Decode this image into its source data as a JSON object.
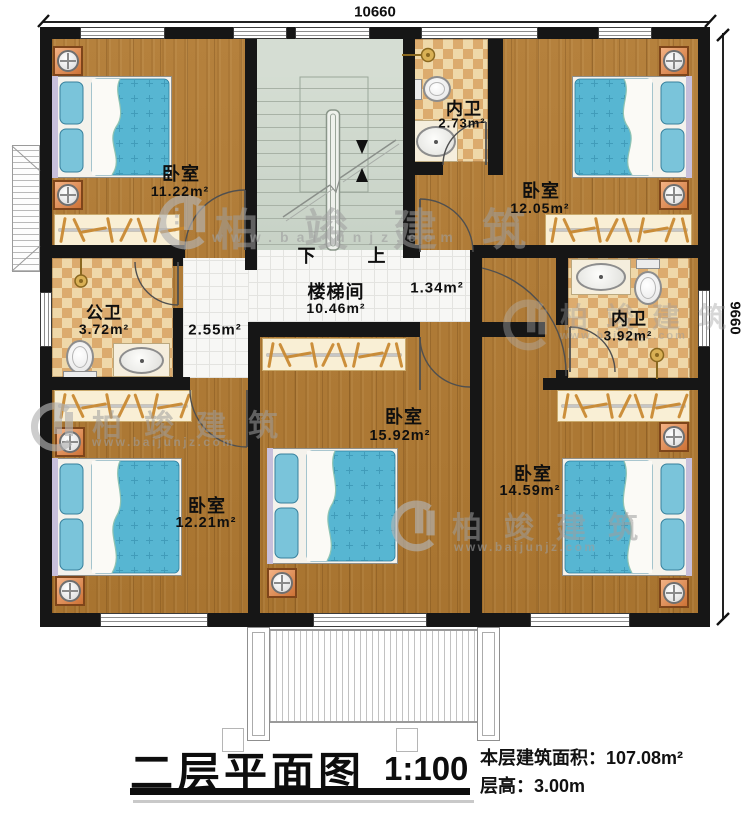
{
  "title_block": {
    "title": "二层平面图",
    "scale": "1:100",
    "area_label": "本层建筑面积：107.08m²",
    "floor_height_label": "层高：3.00m"
  },
  "dimensions": {
    "top": "10660",
    "right": "9660"
  },
  "stair": {
    "down_label": "下",
    "up_label": "上"
  },
  "rooms": [
    {
      "id": "bedroom-top-left",
      "name": "卧室",
      "area": "11.22m²"
    },
    {
      "id": "bath-inner-top",
      "name": "内卫",
      "area": "2.73m²"
    },
    {
      "id": "bedroom-top-right",
      "name": "卧室",
      "area": "12.05m²"
    },
    {
      "id": "bath-public",
      "name": "公卫",
      "area": "3.72m²"
    },
    {
      "id": "stairwell",
      "name": "楼梯间",
      "area": "10.46m²"
    },
    {
      "id": "hall-east",
      "name": "",
      "area": "1.34m²"
    },
    {
      "id": "hall-west",
      "name": "",
      "area": "2.55m²"
    },
    {
      "id": "bath-inner-right",
      "name": "内卫",
      "area": "3.92m²"
    },
    {
      "id": "bedroom-bottom-left",
      "name": "卧室",
      "area": "12.21m²"
    },
    {
      "id": "bedroom-bottom-middle",
      "name": "卧室",
      "area": "15.92m²"
    },
    {
      "id": "bedroom-bottom-right",
      "name": "卧室",
      "area": "14.59m²"
    }
  ],
  "watermark": {
    "brand": "柏竣建筑",
    "url": "www.baijunjz.com"
  },
  "colors": {
    "wall": "#161616",
    "wood_floor": "#ad7a36",
    "bath_tile": "#dcab6e",
    "stair_floor": "#ced8cd",
    "bed": "#57b6d2",
    "furniture_accent": "#d98a4f"
  }
}
